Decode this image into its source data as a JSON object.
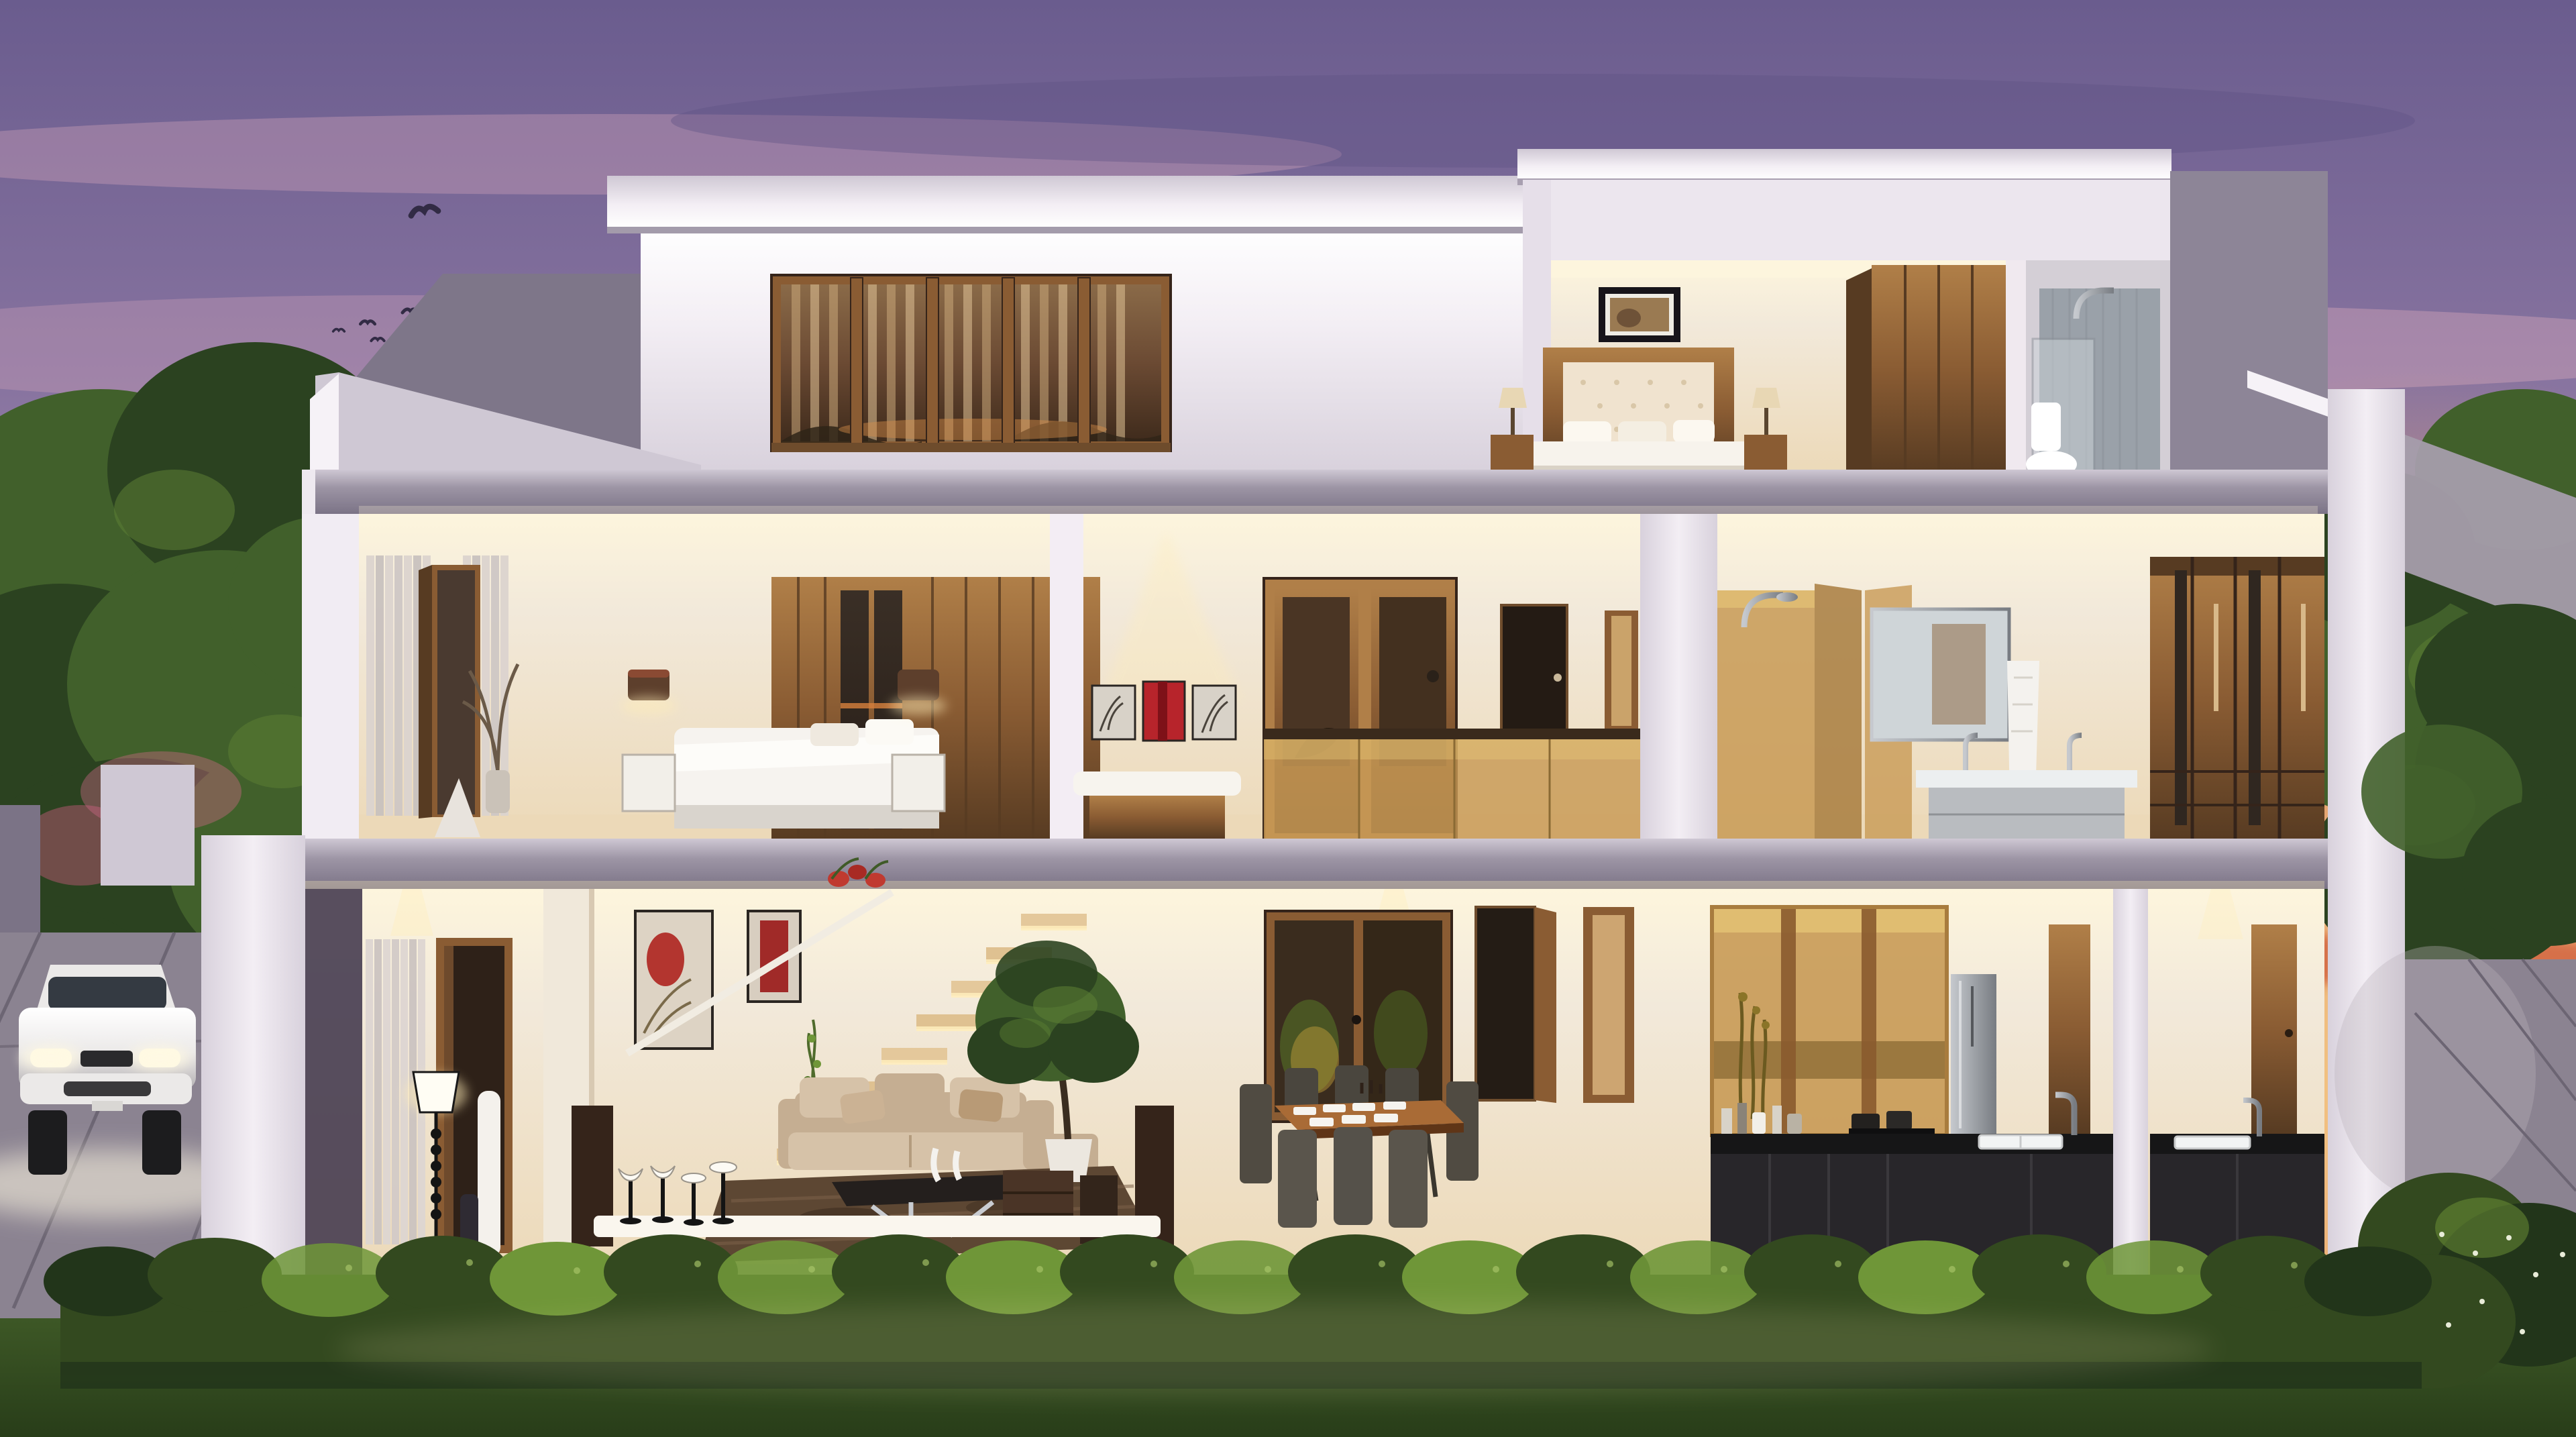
{
  "scene": {
    "type": "3d-architectural-cutaway-render",
    "setting": "modern two-storey villa cross-section at dusk",
    "sky": {
      "description": "purple sunset sky with pink cloud streaks",
      "birds_count": 6
    },
    "house": {
      "floors": [
        {
          "name": "top-floor",
          "rooms": [
            "curtained-window-room",
            "bedroom-with-framed-art",
            "bathroom-with-shower"
          ]
        },
        {
          "name": "second-floor",
          "rooms": [
            "guest-bedroom",
            "master-bedroom",
            "gallery-landing",
            "hallway",
            "shower-enclosure",
            "bathroom-vanity",
            "walk-in-closet"
          ]
        },
        {
          "name": "ground-floor",
          "rooms": [
            "entrance-foyer",
            "living-room",
            "floating-staircase",
            "dining-room",
            "kitchen",
            "utility-area"
          ]
        }
      ],
      "dining_seats": 6,
      "bar_stools": 4
    },
    "exterior": {
      "vehicle": "white sedan with headlights on",
      "vegetation": [
        "left-tree",
        "right-tree",
        "front-hedge",
        "corner-bushes",
        "lawn"
      ],
      "hardscape": [
        "left-driveway",
        "right-paved-patio"
      ]
    }
  },
  "palette": {
    "skyTop": "#6a5c8e",
    "skyMid": "#9c84ac",
    "skyPink": "#c79ab0",
    "cloudPink": "#d9a9bc",
    "cloudDark": "#5e5384",
    "sunsetOrange": "#f0a15e",
    "sunsetYellow": "#f8d287",
    "sunsetRed": "#e05a35",
    "glowPink": "#d4728f",
    "treeDark": "#2b4220",
    "treeMid": "#41602b",
    "treeLit": "#5d8034",
    "trunk": "#3a2d20",
    "wallLit": "#f3eef4",
    "wallShade": "#d8d1dc",
    "wallGrey": "#968fa0",
    "wallDark": "#7b7386",
    "slab": "#9d95a5",
    "slabLit": "#cfc8d4",
    "coping": "#f6f2f7",
    "cream": "#f2e9da",
    "creamBright": "#fdf5dd",
    "warmFloor": "#ecd9b8",
    "glowWarm": "#ffedb8",
    "wood": "#8a5c33",
    "woodLight": "#b07f48",
    "woodDark": "#573b22",
    "woodDeep": "#35241a",
    "amber": "#c89a55",
    "amberDeep": "#a87c3e",
    "amberLite": "#e8c878",
    "mirrorDark": "#2e241d",
    "cabinet": "#28262a",
    "counter": "#161617",
    "steel": "#9fa3a8",
    "steelLight": "#c6c9ce",
    "sofa": "#c5ae92",
    "sofaLight": "#d6c2a8",
    "rug": "#5d4733",
    "rugLight": "#7c614a",
    "hedge": "#33491f",
    "hedgeLit": "#6f9638",
    "hedgeDark": "#22351a",
    "lawn": "#3f5a27",
    "lawnDark": "#283d19",
    "pave": "#8b8391",
    "paveDark": "#6c6573",
    "paveLit": "#b9b2ba",
    "car": "#ebe9e8",
    "carShade": "#b5b2b4",
    "carGlass": "#343a42",
    "headlight": "#fff9e3",
    "white": "#ffffff",
    "offWhite": "#f7f4ee",
    "black": "#1d1b20",
    "red": "#b7242b",
    "redDeep": "#7e1118",
    "doorDark": "#2e2118",
    "chairDark": "#504b42",
    "towel": "#f4f2ee",
    "artBeige": "#d8d2c8"
  }
}
